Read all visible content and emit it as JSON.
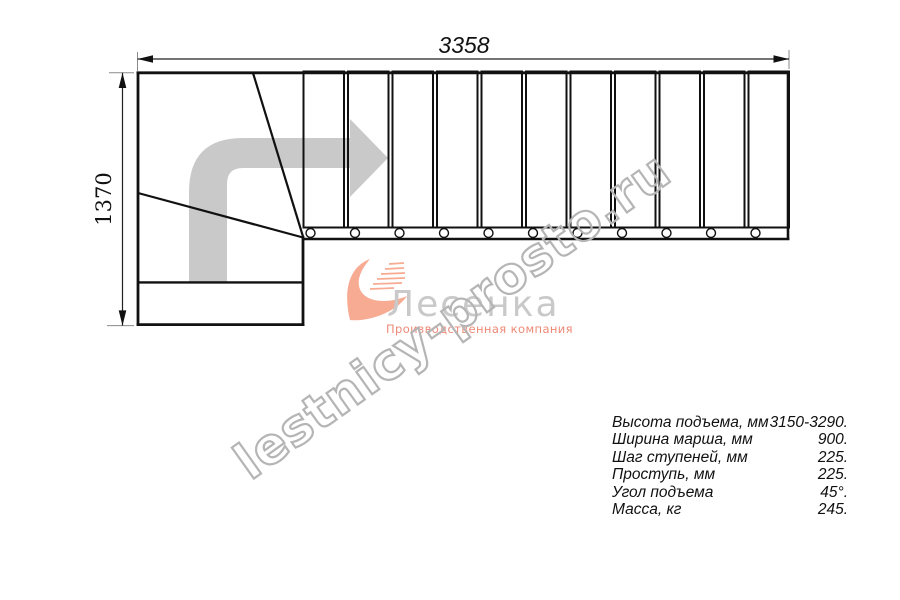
{
  "drawing": {
    "dim_width": "3358",
    "dim_height": "1370"
  },
  "watermark": "lestnicy-prosto.ru",
  "logo": {
    "name": "Лесенка",
    "subtitle": "Производственная компания"
  },
  "specs": {
    "rows": [
      {
        "label": "Высота подъема, мм",
        "value": "3150-3290."
      },
      {
        "label": "Ширина марша, мм",
        "value": "900."
      },
      {
        "label": "Шаг ступеней, мм",
        "value": "225."
      },
      {
        "label": "Проступь, мм",
        "value": "225."
      },
      {
        "label": "Угол подъема",
        "value": "45°."
      },
      {
        "label": "Масса, кг",
        "value": "245."
      }
    ]
  },
  "colors": {
    "line": "#111111",
    "extension_line": "#8a8a8a",
    "walk_arrow": "#c9c9c9",
    "watermark": "#b5b5b5",
    "logo_accent": "#f6ab92",
    "logo_text": "#c9c9c9",
    "logo_subtitle": "#ee8976"
  }
}
